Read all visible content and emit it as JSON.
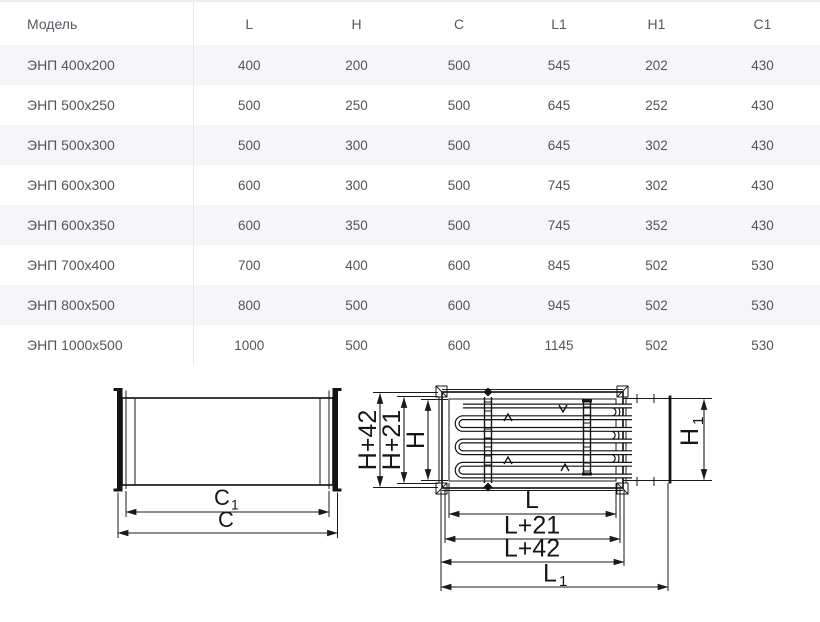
{
  "table": {
    "columns": [
      "Модель",
      "L",
      "H",
      "C",
      "L1",
      "H1",
      "C1"
    ],
    "rows": [
      [
        "ЭНП 400x200",
        "400",
        "200",
        "500",
        "545",
        "202",
        "430"
      ],
      [
        "ЭНП 500x250",
        "500",
        "250",
        "500",
        "645",
        "252",
        "430"
      ],
      [
        "ЭНП 500x300",
        "500",
        "300",
        "500",
        "645",
        "302",
        "430"
      ],
      [
        "ЭНП 600x300",
        "600",
        "300",
        "500",
        "745",
        "302",
        "430"
      ],
      [
        "ЭНП 600x350",
        "600",
        "350",
        "500",
        "745",
        "352",
        "430"
      ],
      [
        "ЭНП 700x400",
        "700",
        "400",
        "600",
        "845",
        "502",
        "530"
      ],
      [
        "ЭНП 800x500",
        "800",
        "500",
        "600",
        "945",
        "502",
        "530"
      ],
      [
        "ЭНП 1000x500",
        "1000",
        "500",
        "600",
        "1145",
        "502",
        "530"
      ]
    ]
  },
  "drawings": {
    "duct": {
      "dim_c1_main": "C",
      "dim_c1_sub": "1",
      "dim_c": "C"
    },
    "heater": {
      "dim_h42": "H+42",
      "dim_h21": "H+21",
      "dim_h": "H",
      "dim_h1_main": "H",
      "dim_h1_sub": "1",
      "dim_l": "L",
      "dim_l21": "L+21",
      "dim_l42": "L+42",
      "dim_l1_main": "L",
      "dim_l1_sub": "1"
    }
  },
  "colors": {
    "row_alt": "#f6f6f8",
    "divider": "#e9e9ec",
    "table_text": "#53555c",
    "drawing_line": "#1a1a1a"
  }
}
